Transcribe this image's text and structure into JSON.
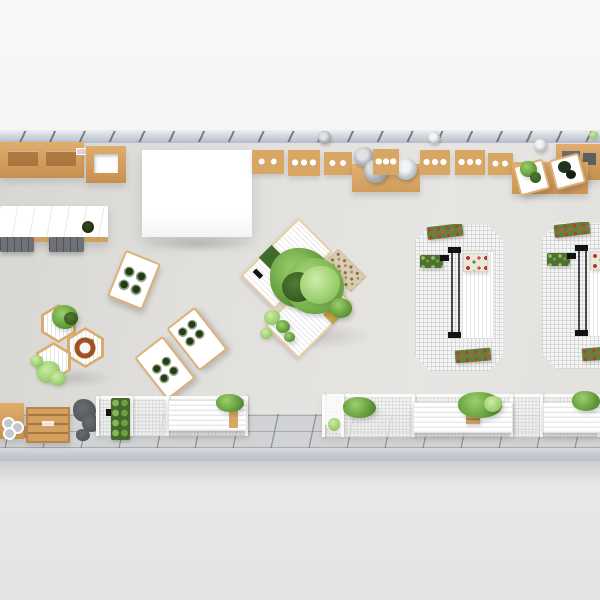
{
  "scene": {
    "type": "3d-top-down-interior-render",
    "description": "Bird's-eye 3D render of a long narrow plant-shop / garden cafe interior with wooden wall counters, a white canopy, a marble bar, hexagonal planter tables, a central green-planted island, white wire-mesh display racks with red flowers, and slatted benches along a tiled walkway",
    "visible_text": [],
    "palette": {
      "background_top": "#f8f8f8",
      "background_bottom": "#e3e3e3",
      "top_wall": "#c6ccd5",
      "bottom_wall": "#c2c8d0",
      "floor": "#e2e0dd",
      "tile": "#d1d2d3",
      "tile_line": "#55595f",
      "wood": "#d8a763",
      "wood_dark": "#b9854b",
      "canopy_white": "#ffffff",
      "marble_white": "#ffffff",
      "mesh_white": "#f4f5f4",
      "foliage_green": "#68a03f",
      "foliage_light": "#b8e08d",
      "foliage_dark": "#35581f",
      "flower_red": "#c0392b",
      "flower_rust": "#a0511f",
      "stool_gray": "#6e7175",
      "bowl_gray": "#aeb4b9"
    },
    "objects": [
      {
        "name": "top-wall",
        "note": "light blue-gray wall band with bracket hooks"
      },
      {
        "name": "wall-counter-left",
        "note": "wooden cabinet run, top-left"
      },
      {
        "name": "box-shelf",
        "note": "wooden open-box shelf with white interior"
      },
      {
        "name": "white-canopy",
        "note": "large bright white hanging canopy/screen"
      },
      {
        "name": "sink-cabinets",
        "note": "seven wooden wall cabinets with white basin circles"
      },
      {
        "name": "bowl-stacks",
        "note": "stacked gray bowls/pots on wooden prep tables"
      },
      {
        "name": "plant-prep-tables",
        "note": "two small white tables with green and dark plants on a wooden mat"
      },
      {
        "name": "wood-bench-top-right",
        "note": "wooden counter with dark gray inset trays"
      },
      {
        "name": "marble-bar",
        "note": "white marble counter with wood edge, dark plant, two gray stools"
      },
      {
        "name": "pot-side-table",
        "note": "rotated white table with four green pots"
      },
      {
        "name": "island-planter",
        "note": "central diamond island of slatted white tables with a large green plant, pebble tray and gold box"
      },
      {
        "name": "hexagon-tables",
        "note": "three hexagonal slatted tables with green plants and a rust flower ring"
      },
      {
        "name": "pot-tables-pair",
        "note": "two rotated white tables each with four dark pots"
      },
      {
        "name": "mesh-display-rack",
        "note": "two octagonal white wire-mesh racks with red flower boxes and green planters"
      },
      {
        "name": "bottom-fence",
        "note": "white mesh railing run with posts and an entrance gap"
      },
      {
        "name": "slatted-benches",
        "note": "three white slatted benches with green planters and a wooden basket"
      },
      {
        "name": "wooden-console",
        "note": "bottom-left wooden cabinet with white ring pots and a crate"
      },
      {
        "name": "dark-plant",
        "note": "gray-silhouette plant near bottom-left"
      },
      {
        "name": "tiled-walkway",
        "note": "gray floor tiles along the bottom wall"
      }
    ]
  }
}
